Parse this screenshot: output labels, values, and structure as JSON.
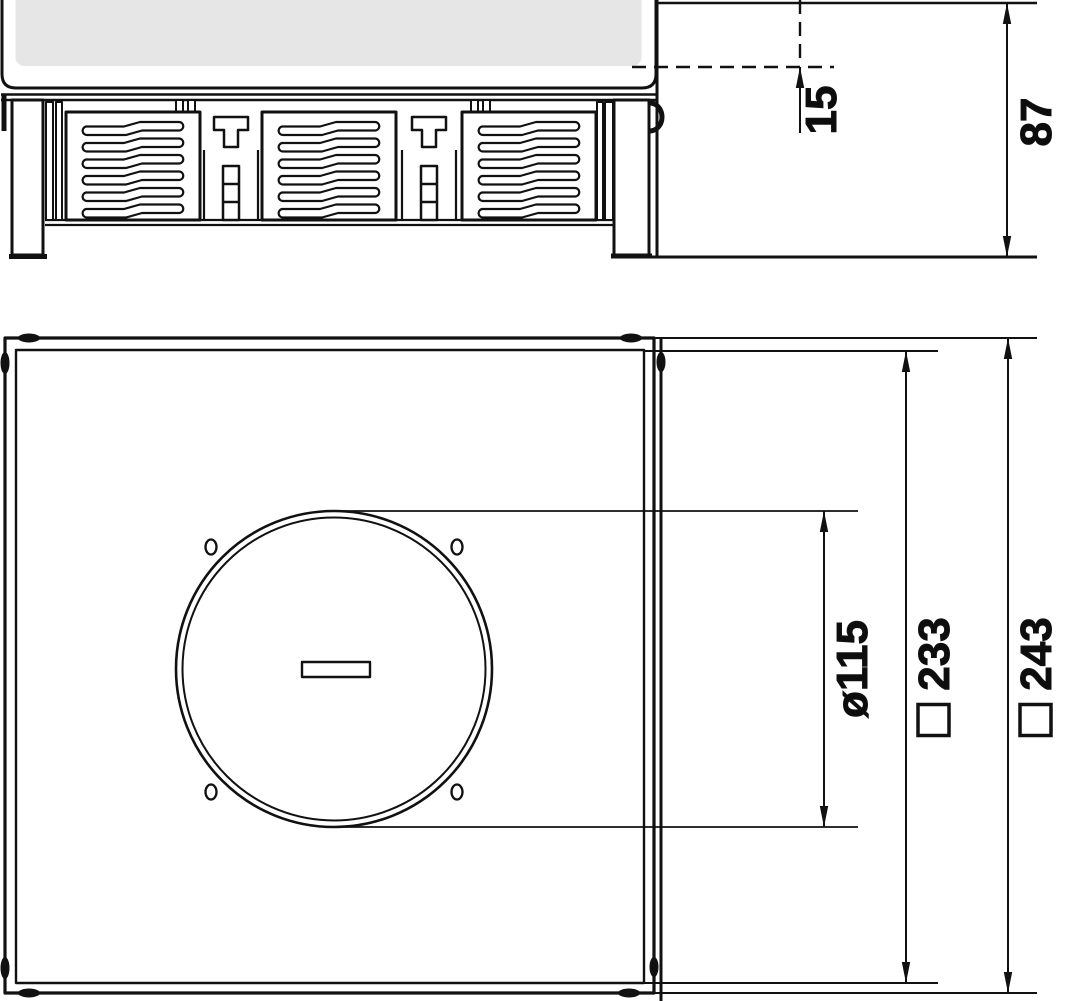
{
  "drawing": {
    "type": "technical-dimension-drawing",
    "views": {
      "side_view": {
        "name": "side-section-elevation",
        "dims": {
          "recess_depth": {
            "label": "15",
            "orientation": "vertical-rotated"
          },
          "overall_height": {
            "label": "87",
            "orientation": "vertical-rotated"
          }
        }
      },
      "plan_view": {
        "name": "top-plan-view",
        "dims": {
          "lid_diameter": {
            "label": "ø115",
            "orientation": "vertical-rotated"
          },
          "cover_square": {
            "label": "233",
            "prefix_symbol": "□",
            "orientation": "vertical-rotated"
          },
          "frame_square": {
            "label": "243",
            "prefix_symbol": "□",
            "orientation": "vertical-rotated"
          }
        }
      }
    },
    "symbols": {
      "diameter": "ø",
      "square": "□"
    },
    "colors": {
      "line": "#111111",
      "lid_fill": "#e6e6e6",
      "background": "#ffffff"
    }
  }
}
